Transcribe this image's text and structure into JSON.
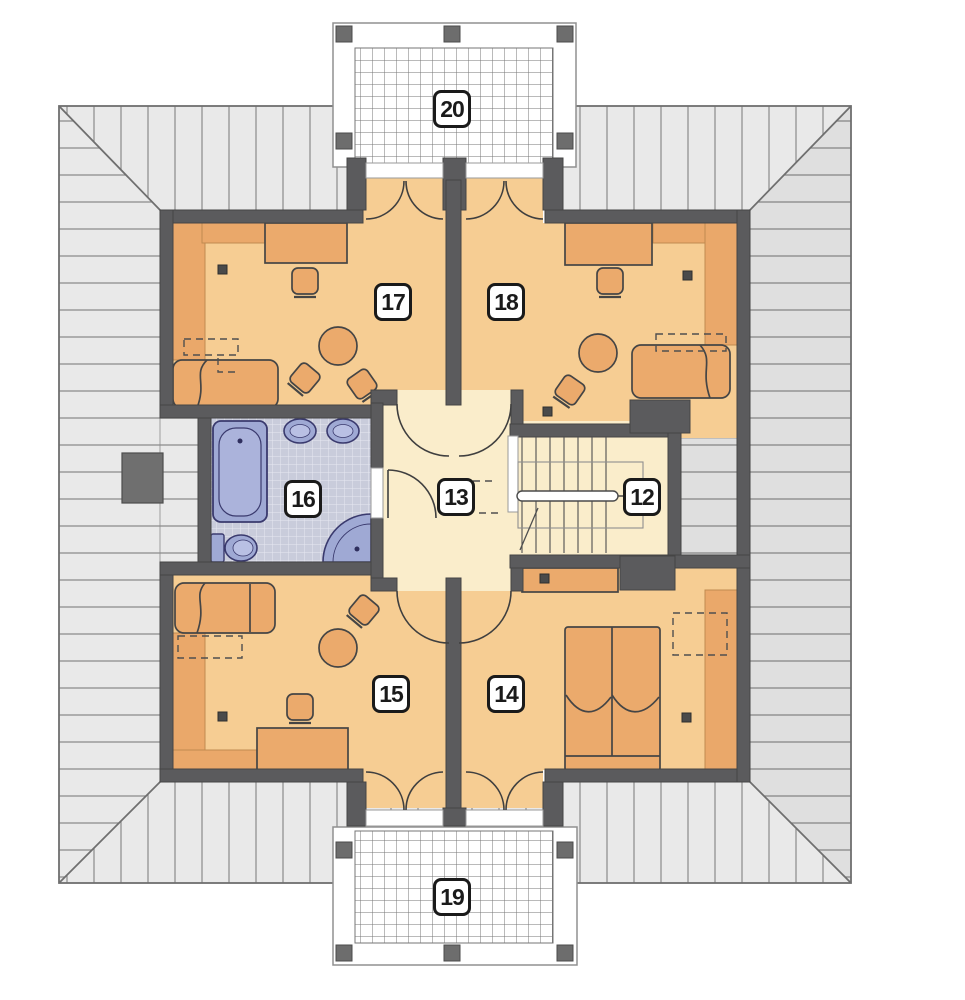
{
  "plan": {
    "room_labels": {
      "r12": "12",
      "r13": "13",
      "r14": "14",
      "r15": "15",
      "r16": "16",
      "r17": "17",
      "r18": "18",
      "r19": "19",
      "r20": "20"
    }
  },
  "colors": {
    "wall": "#5B5B5D",
    "room_floor": "#F6CD93",
    "hall_floor": "#FAEDCB",
    "sloped_ceiling_band": "#EAA86A",
    "furniture": "#EBAA6C",
    "bath_fixture_blue": "#9FA9D4",
    "bath_tile": "#C9CCDB",
    "roof_light": "#E9E9E9",
    "roof_shaded": "#DFDFDF",
    "balcony_floor": "#FFFFFF",
    "outline": "#454545"
  }
}
